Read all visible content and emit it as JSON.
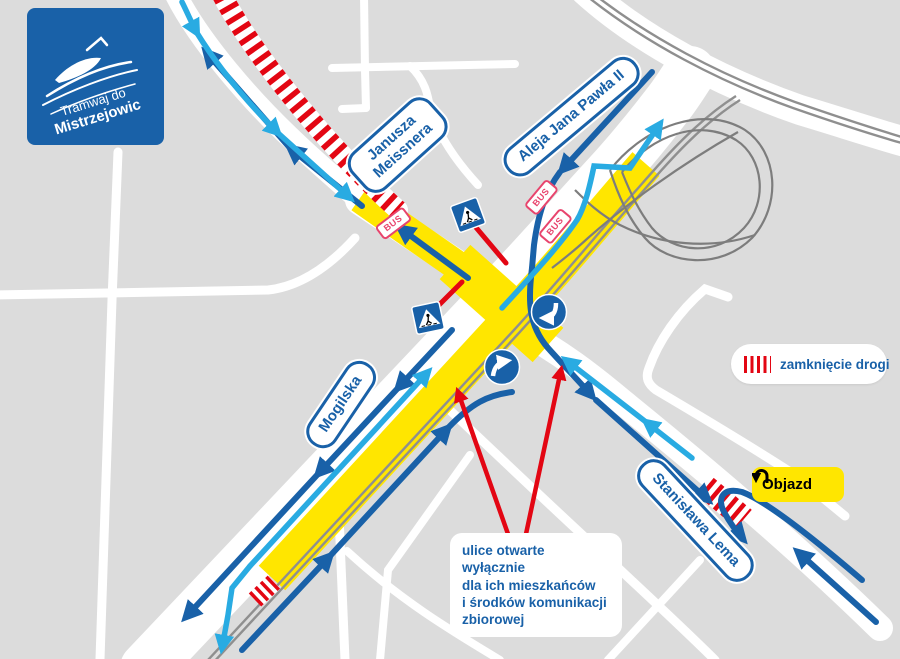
{
  "logo": {
    "line1": "Tramwaj do",
    "line2": "Mistrzejowic"
  },
  "street_labels": {
    "meissnera": "Janusza\nMeissnera",
    "jp2": "Aleja Jana Pawła II",
    "mogilska": "Mogilska",
    "lema": "Stanisława Lema"
  },
  "badges": {
    "bus": "BUS",
    "objazd": "Objazd"
  },
  "legend": {
    "closure": "zamknięcie drogi"
  },
  "annotation": {
    "text": "ulice otwarte wyłącznie\ndla ich mieszkańców\ni środków komunikacji\nzbiorowej"
  },
  "colors": {
    "background": "#dcdcdc",
    "road": "#ffffff",
    "bus_lane_yellow": "#ffe600",
    "closure_red": "#e30613",
    "traffic_dark_blue": "#1961a8",
    "traffic_cyan": "#29abe2",
    "tram_track_gray": "#8f8f8f",
    "bus_badge_pink": "#e8446d",
    "logo_blue": "#1961a8"
  }
}
